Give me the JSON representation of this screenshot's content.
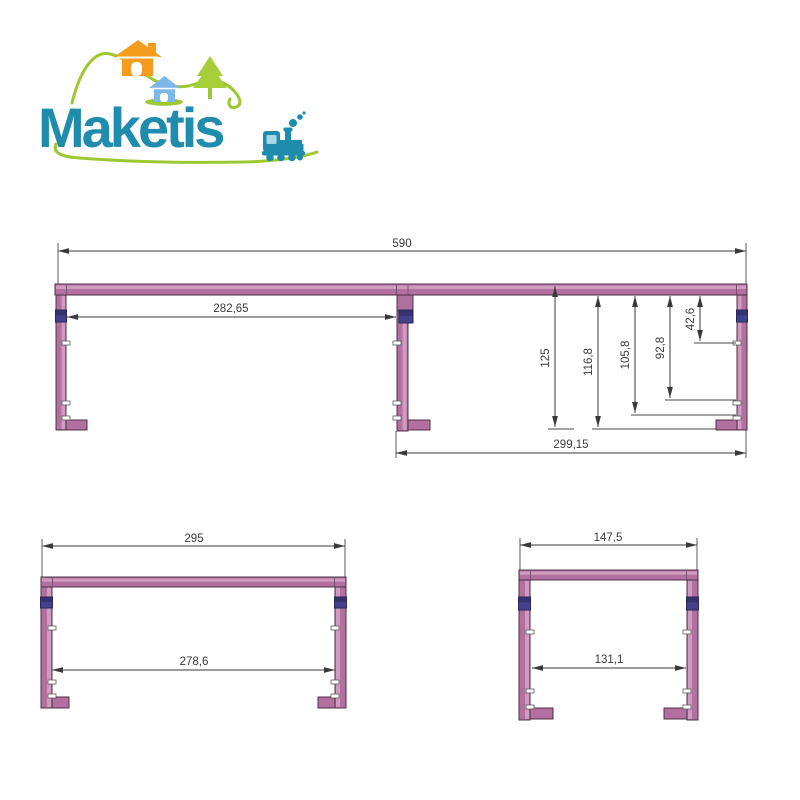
{
  "logo": {
    "brand": "Maketis",
    "icons": [
      "hills-swoosh",
      "orange-house",
      "blue-house",
      "pine-tree",
      "train",
      "underline-swoosh"
    ],
    "colors": {
      "teal": "#1f8cad",
      "orange": "#f59c1e",
      "light_blue": "#7cb9e8",
      "green": "#9cc832",
      "window_blue": "#a8d8ea"
    }
  },
  "drawing": {
    "colors": {
      "frame_pink": "#b1709f",
      "frame_highlight": "#cf9cc0",
      "frame_outline": "#503048",
      "connector_blue": "#44418c",
      "foot_purple": "#5a3f91",
      "dimension_gray": "#3a3a3a"
    },
    "top_view": {
      "width_total": "590",
      "width_inner_left": "282,65",
      "width_inner_right": "299,15",
      "height_total": "125",
      "height_inner": "116,8",
      "height_notch_3": "105,8",
      "height_notch_2": "92,8",
      "height_notch_1": "42,6"
    },
    "front_view": {
      "width_total": "295",
      "width_inner": "278,6"
    },
    "side_view": {
      "width_total": "147,5",
      "width_inner": "131,1"
    }
  }
}
